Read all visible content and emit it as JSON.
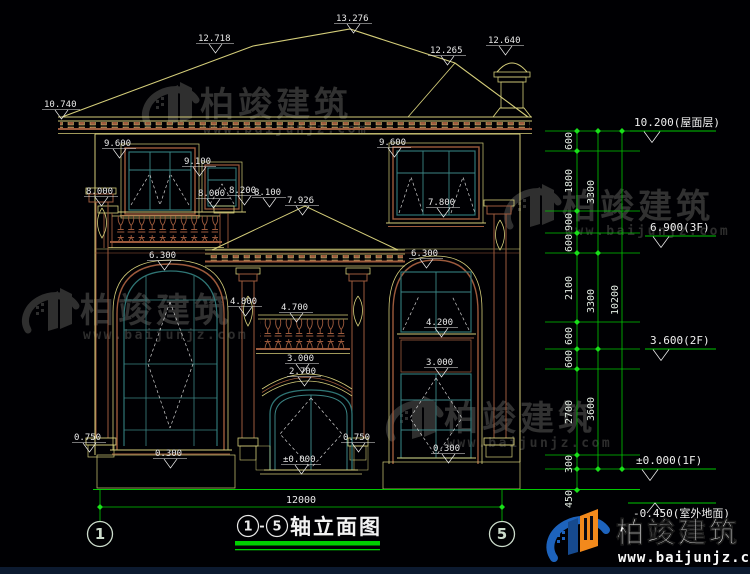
{
  "watermark": {
    "brand": "柏竣建筑",
    "url": "www.baijunjz.com"
  },
  "footer_logo": {
    "brand": "柏竣建筑",
    "url": "www.baijunjz.com"
  },
  "title_bar": {
    "from": "1",
    "dash": "-",
    "to": "5",
    "label": "轴立面图"
  },
  "axis_markers": {
    "left": "1",
    "right": "5"
  },
  "facade_width": "12000",
  "levels": {
    "roof": "10.200(屋面层)",
    "f3": "6.900(3F)",
    "f2": "3.600(2F)",
    "f1": "±0.000(1F)",
    "ground": "-0.450(室外地面)"
  },
  "dim_chain": {
    "seg": [
      "600",
      "1800",
      "900",
      "600",
      "2100",
      "600",
      "600",
      "2700",
      "300",
      "450"
    ],
    "sub": [
      "3300",
      "3300",
      "3600"
    ],
    "total": "10200"
  },
  "callouts": {
    "eave_left": "10.740",
    "ridge_left": "12.718",
    "ridge_main": "13.276",
    "roof_right": "12.265",
    "chimney": "12.640",
    "w3f_left": "9.600",
    "w3f_small": "9.100",
    "lv8000_l": "8.000",
    "lv8000_c": "8.000",
    "lv8200": "8.200",
    "lv8100": "8.100",
    "porch_ridge": "7.926",
    "w3f_right": "9.600",
    "w3f_right_sill": "7.800",
    "arch_left": "6.300",
    "arch_right": "6.300",
    "balcony_top": "4.800",
    "balcony_rail": "4.700",
    "door_arch_top": "3.000",
    "door_arch": "2.700",
    "w2f_right_sill": "4.200",
    "w1f_right_top": "3.000",
    "pedestal_left": "0.750",
    "sill_left": "0.300",
    "threshold": "±0.000",
    "sill_right": "0.300",
    "pedestal_center": "0.750"
  }
}
